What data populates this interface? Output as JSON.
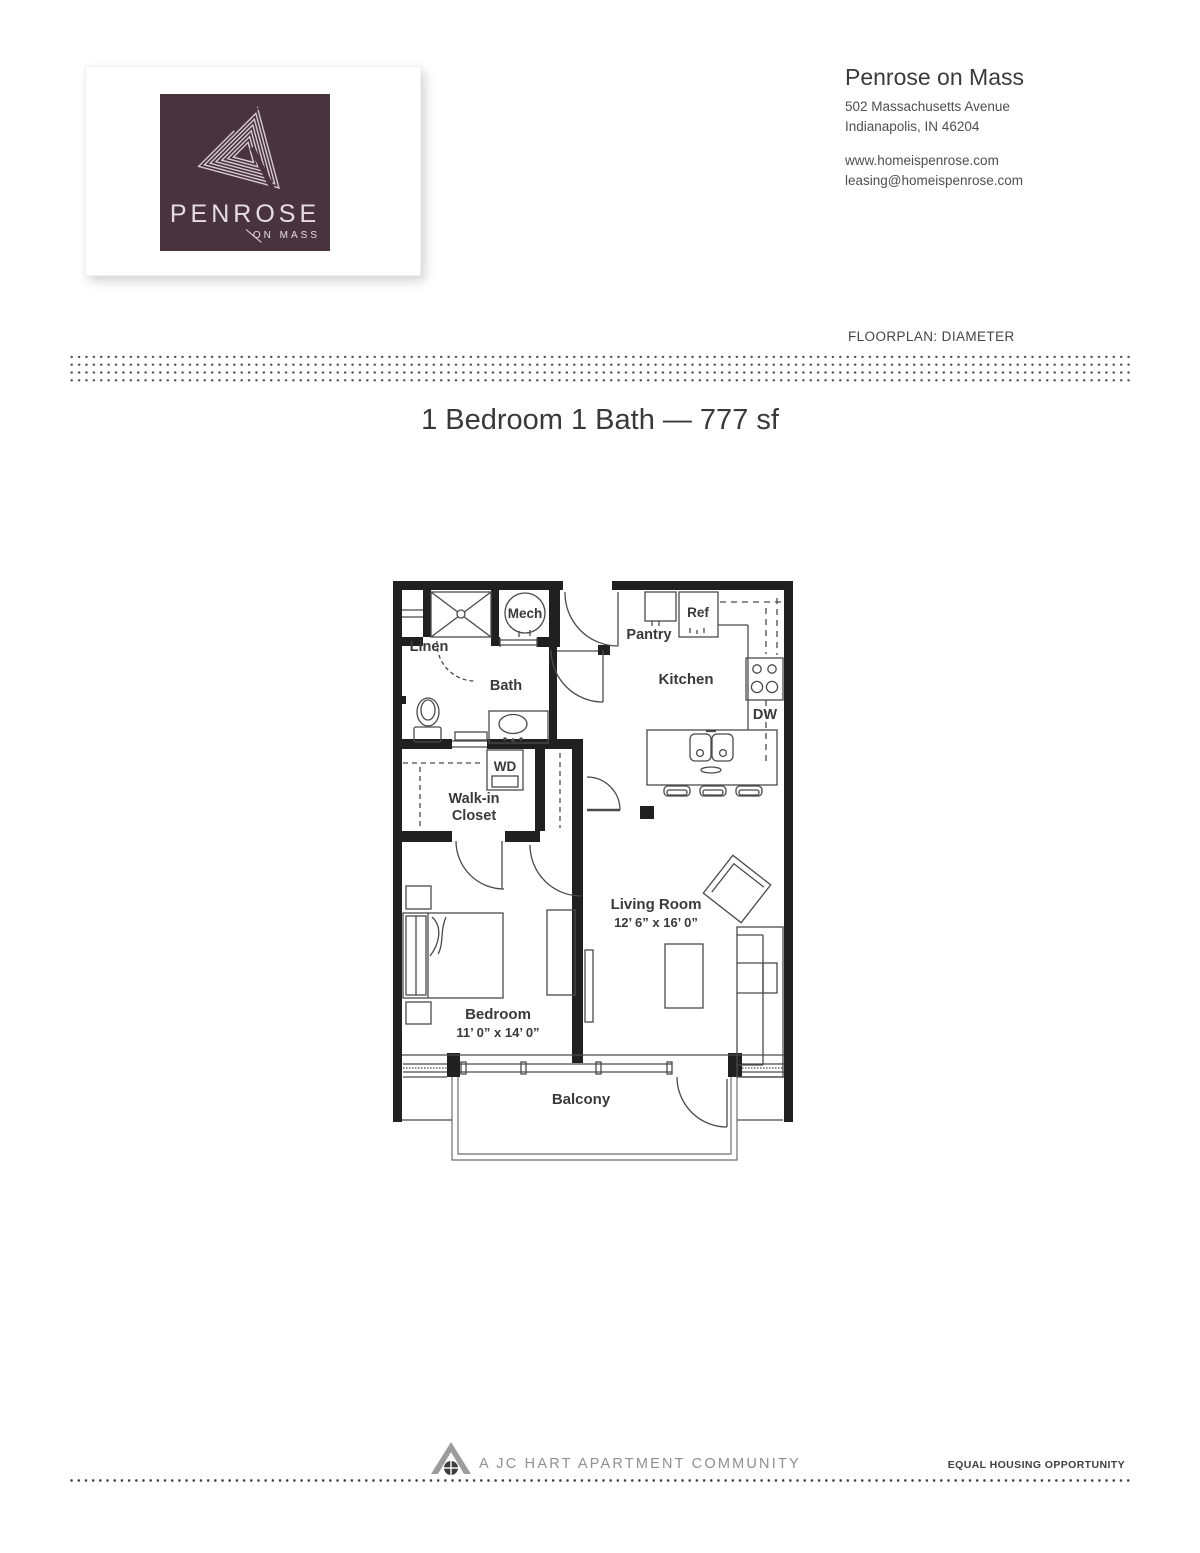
{
  "logo": {
    "brand": "PENROSE",
    "sub": "ON MASS"
  },
  "header": {
    "title": "Penrose on Mass",
    "address1": "502 Massachusetts Avenue",
    "address2": "Indianapolis, IN 46204",
    "website": "www.homeispenrose.com",
    "email": "leasing@homeispenrose.com"
  },
  "floorplan_label": "FLOORPLAN: DIAMETER",
  "unit_title": "1 Bedroom 1 Bath — 777 sf",
  "plan": {
    "name": "Diameter",
    "bedrooms": 1,
    "bathrooms": 1,
    "square_feet": 777,
    "labels": {
      "mech": "Mech",
      "linen": "Linen",
      "bath": "Bath",
      "wd": "WD",
      "walkin1": "Walk-in",
      "walkin2": "Closet",
      "pantry": "Pantry",
      "ref": "Ref",
      "kitchen": "Kitchen",
      "dw": "DW",
      "living": "Living Room",
      "living_dims": "12’ 6” x 16’ 0”",
      "bedroom": "Bedroom",
      "bedroom_dims": "11’ 0” x 14’ 0”",
      "balcony": "Balcony"
    }
  },
  "footer": {
    "community": "A JC HART APARTMENT COMMUNITY",
    "equal_housing": "EQUAL HOUSING OPPORTUNITY"
  },
  "colors": {
    "brand_plum": "#49333f",
    "wall": "#202020",
    "line": "#4a4a4a",
    "text_dark": "#3a3a3a",
    "text_gray": "#8f8f8f"
  }
}
